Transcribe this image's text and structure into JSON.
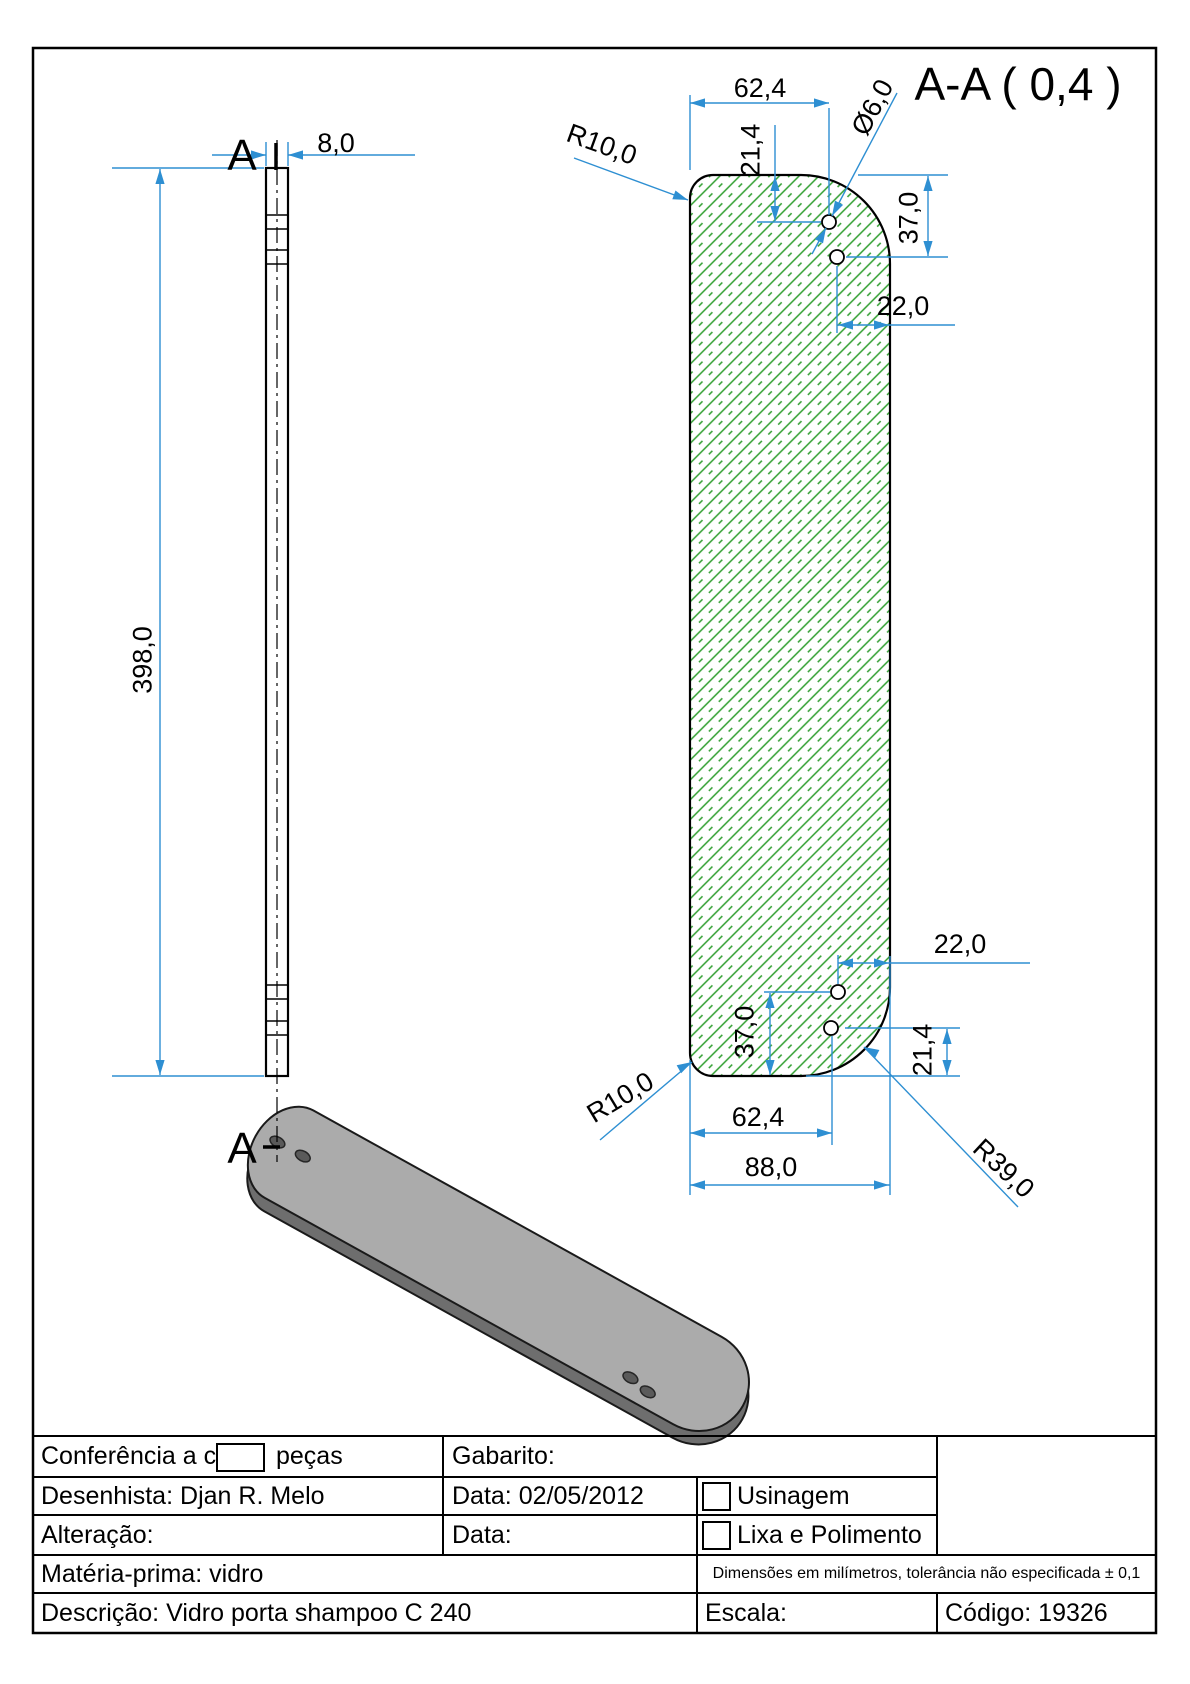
{
  "drawing": {
    "section_title": "A-A ( 0,4 )",
    "section_label_top": "A",
    "section_label_bottom": "A",
    "dims": {
      "side_thickness": "8,0",
      "side_length": "398,0",
      "top_hole_offset_x": "62,4",
      "top_hole_offset_y": "21,4",
      "hole_diameter": "Ø6,0",
      "top_hole2_offset_y": "37,0",
      "top_hole2_offset_x": "22,0",
      "top_corner_radius": "R10,0",
      "bottom_hole2_offset_x": "22,0",
      "bottom_hole2_offset_y": "37,0",
      "bottom_hole_offset_y": "21,4",
      "bottom_hole_offset_x": "62,4",
      "plate_width": "88,0",
      "bottom_corner_radius": "R10,0",
      "bottom_right_corner_radius": "R39,0"
    }
  },
  "title_block": {
    "conferencia_label": "Conferência a cada",
    "pecas_label": "peças",
    "gabarito_label": "Gabarito:",
    "desenhista_label": "Desenhista:",
    "desenhista_value": "Djan R. Melo",
    "data_label": "Data:",
    "data_value": "02/05/2012",
    "usinagem_label": "Usinagem",
    "alteracao_label": "Alteração:",
    "data2_label": "Data:",
    "lixa_label": "Lixa e Polimento",
    "materia_label": "Matéria-prima:",
    "materia_value": "vidro",
    "tolerancia_note": "Dimensões em milímetros, tolerância não especificada ± 0,1",
    "descricao_label": "Descrição:",
    "descricao_value": "Vidro porta shampoo C 240",
    "escala_label": "Escala:",
    "codigo_label": "Código:",
    "codigo_value": "19326"
  },
  "colors": {
    "dimension_blue": "#2e8fd2",
    "hatch_green": "#2f9e2f",
    "outline_black": "#000000",
    "plate_top_gray": "#ababab",
    "plate_side_gray": "#6e6e6e"
  }
}
